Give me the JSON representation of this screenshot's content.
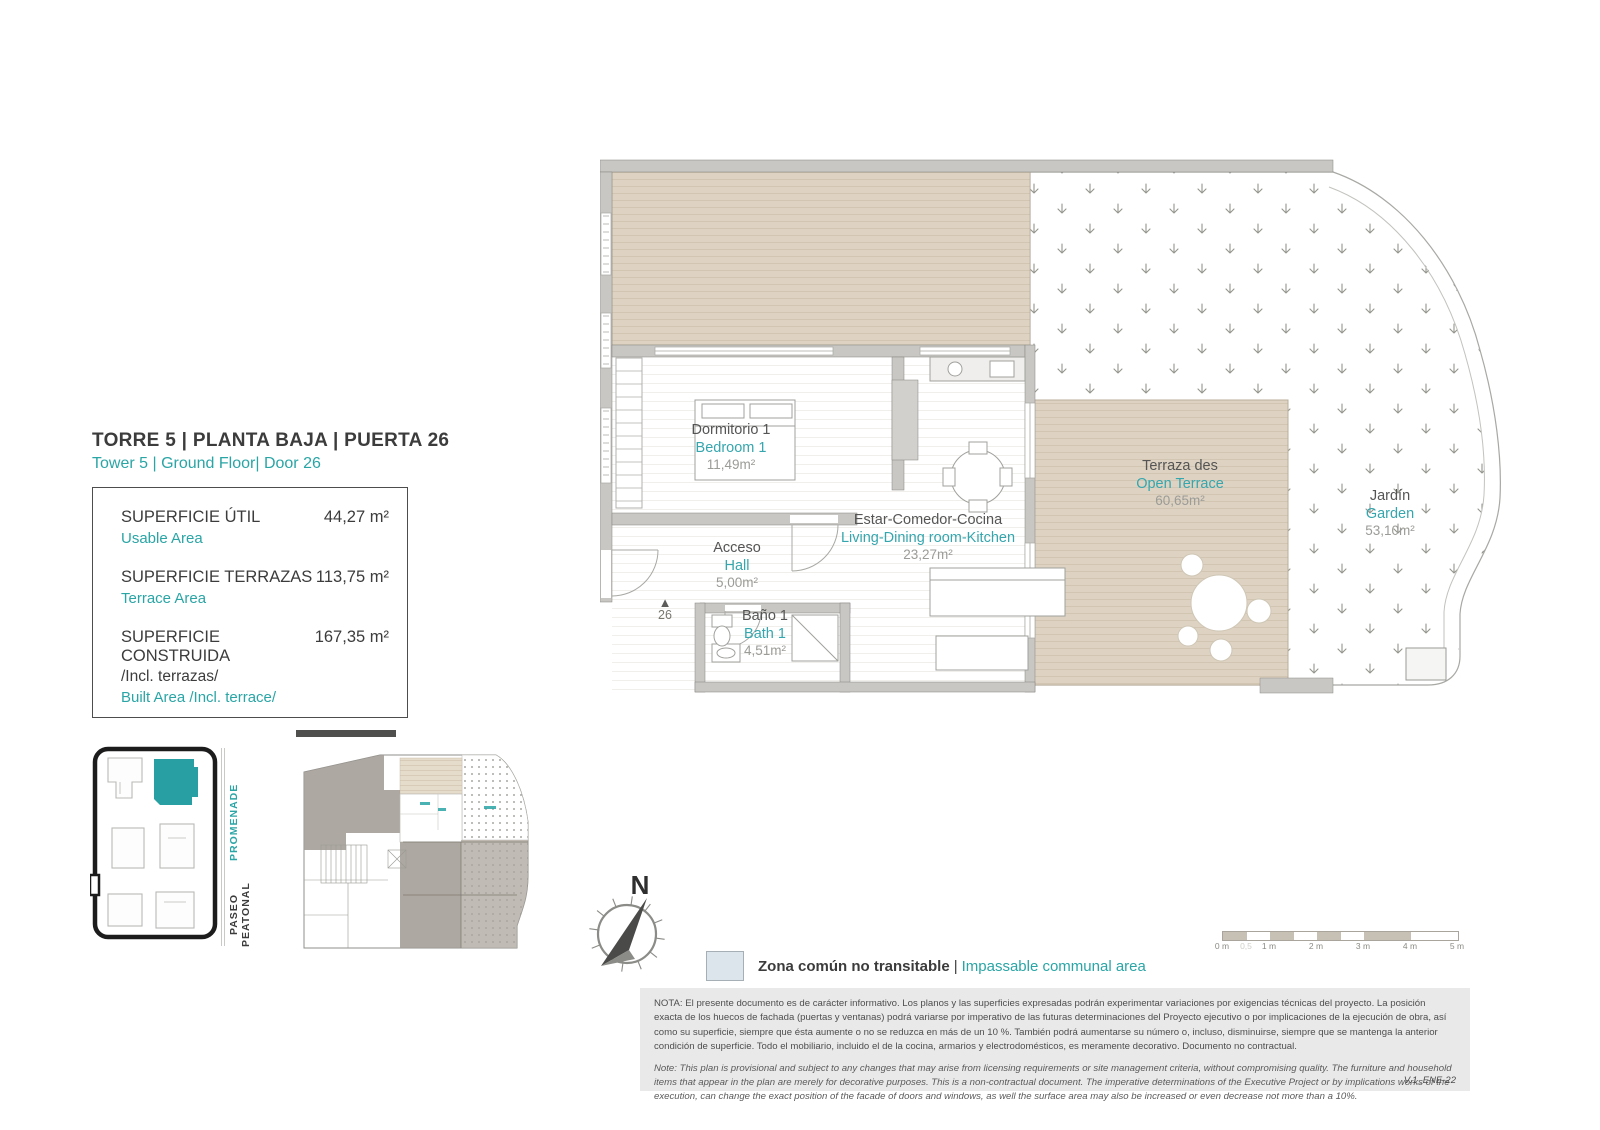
{
  "colors": {
    "accent_teal": "#2aa5a6",
    "deck_beige": "#ded3c2",
    "wall_gray": "#c9c7c3",
    "legend_swatch_blue": "#dde5ec",
    "highlight_building_teal": "#28a0a3"
  },
  "header": {
    "title": "TORRE 5 | PLANTA BAJA | PUERTA 26",
    "subtitle": "Tower 5 | Ground Floor| Door 26"
  },
  "areas": {
    "rows": [
      {
        "label_es": "SUPERFICIE ÚTIL",
        "label_en": "Usable Area",
        "value": "44,27 m²"
      },
      {
        "label_es": "SUPERFICIE TERRAZAS",
        "label_en": "Terrace Area",
        "value": "113,75 m²"
      },
      {
        "label_es": "SUPERFICIE CONSTRUIDA",
        "label_es_extra": "/Incl. terrazas/",
        "label_en": "Built Area /Incl. terrace/",
        "value": "167,35 m²"
      }
    ]
  },
  "rooms": [
    {
      "name_es": "Dormitorio 1",
      "name_en": "Bedroom 1",
      "area": "11,49m²"
    },
    {
      "name_es": "Estar-Comedor-Cocina",
      "name_en": "Living-Dining room-Kitchen",
      "area": "23,27m²"
    },
    {
      "name_es": "Acceso",
      "name_en": "Hall",
      "area": "5,00m²"
    },
    {
      "name_es": "Baño 1",
      "name_en": "Bath 1",
      "area": "4,51m²"
    },
    {
      "name_es": "Terraza des",
      "name_en": "Open Terrace",
      "area": "60,65m²"
    },
    {
      "name_es": "Jardín",
      "name_en": "Garden",
      "area": "53,10m²"
    }
  ],
  "entrance": {
    "door_number": "26"
  },
  "compass": {
    "north_label": "N"
  },
  "scalebar": {
    "labels": [
      "0 m",
      "1 m",
      "2 m",
      "3 m",
      "4 m",
      "5 m"
    ],
    "half_label": "0,5"
  },
  "legend": {
    "label_es": "Zona común no transitable",
    "separator": "|",
    "label_en": "Impassable communal area"
  },
  "site_plan": {
    "street_es": "PASEO PEATONAL",
    "street_en": "PROMENADE"
  },
  "notes": {
    "es": "NOTA:  El presente documento es de carácter informativo. Los planos y las superficies expresadas podrán experimentar variaciones por exigencias técnicas del proyecto. La posición exacta de los huecos de fachada (puertas y ventanas) podrá variarse por imperativo de las futuras determinaciones del Proyecto ejecutivo o por implicaciones de la ejecución de obra, así como su superficie, siempre que ésta aumente o no se reduzca en más de un 10 %. También podrá aumentarse su número o, incluso, disminuirse, siempre que se mantenga la anterior condición de superficie. Todo el mobiliario, incluido el de la cocina, armarios y electrodomésticos, es meramente decorativo. Documento no contractual.",
    "en": "Note: This plan is provisional and subject to any changes that may arise from licensing requirements or site management criteria, without compromising quality. The furniture and household items that appear in the plan are merely for decorative purposes. This is a non-contractual document. The imperative determinations of the Executive Project or by implications works of the execution, can change the exact position of the facade of doors and windows, as well the surface area may also be increased or even decrease not more than a 10%.",
    "version": "V.1_ENE-22"
  }
}
